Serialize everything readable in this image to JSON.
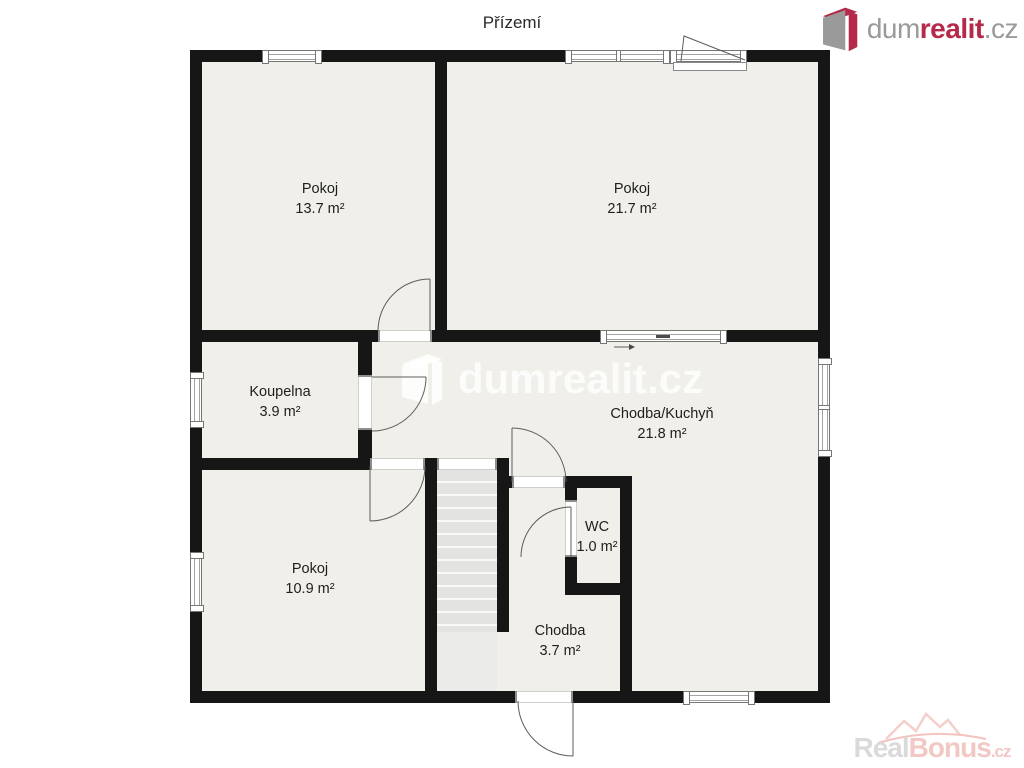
{
  "page": {
    "title": "Přízemí"
  },
  "branding": {
    "logo_topright": {
      "prefix": "dum",
      "highlight": "realit",
      "suffix": ".cz",
      "gray": "#9a9a9a",
      "red": "#b5294a"
    },
    "watermark_center": {
      "text": "dumrealit.cz"
    },
    "watermark_corner": {
      "prefix": "Real",
      "highlight": "Bonus",
      "suffix": ".cz",
      "gray": "#dadada",
      "pink": "#f2c8c4"
    }
  },
  "floorplan": {
    "wall_color": "#161616",
    "floor_color": "#f0efe9",
    "rooms": [
      {
        "name": "Pokoj",
        "area": "13.7 m²"
      },
      {
        "name": "Pokoj",
        "area": "21.7 m²"
      },
      {
        "name": "Koupelna",
        "area": "3.9 m²"
      },
      {
        "name": "Chodba/Kuchyň",
        "area": "21.8 m²"
      },
      {
        "name": "Pokoj",
        "area": "10.9 m²"
      },
      {
        "name": "WC",
        "area": "1.0 m²"
      },
      {
        "name": "Chodba",
        "area": "3.7 m²"
      }
    ]
  }
}
